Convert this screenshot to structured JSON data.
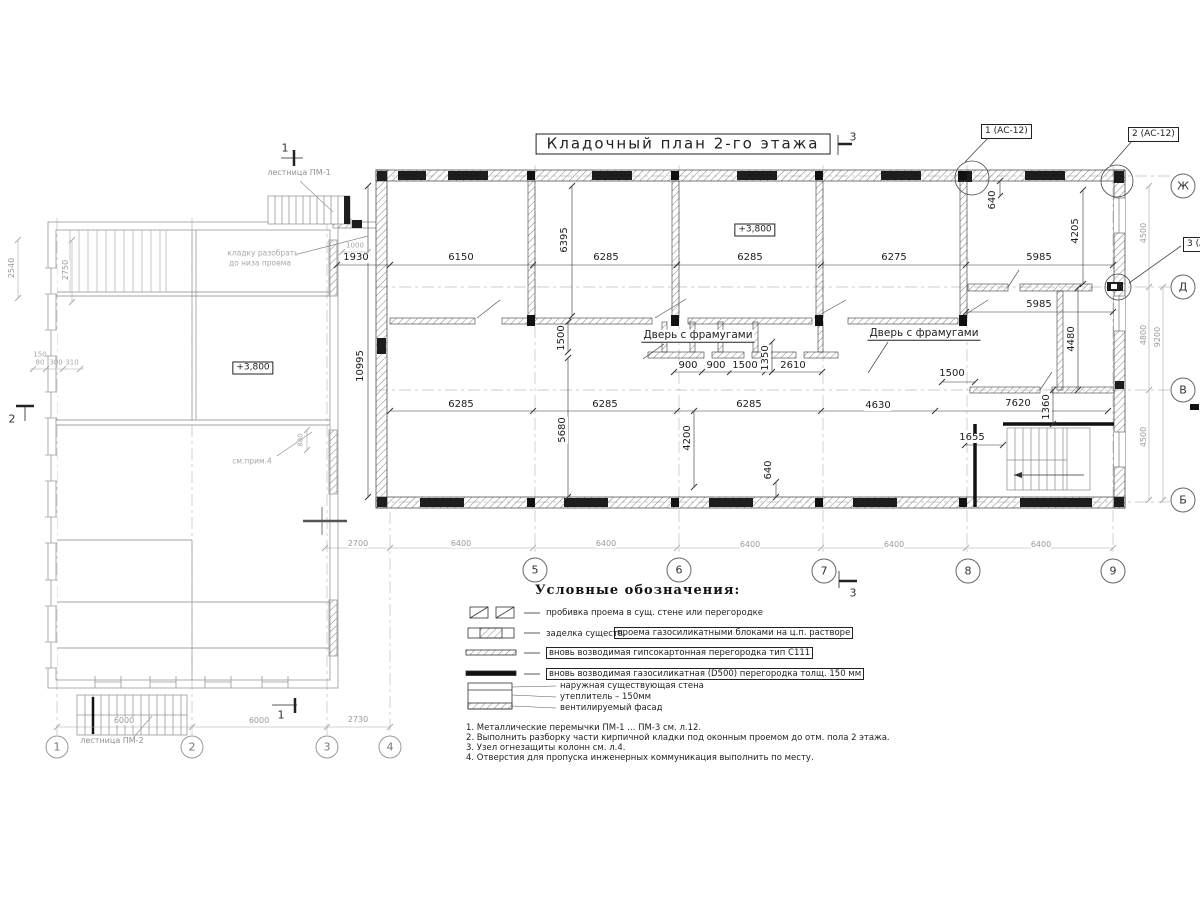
{
  "drawing": {
    "title": "Кладочный план 2-го этажа",
    "level_main": "+3,800",
    "level_left": "+3,800",
    "door_label_left": "Дверь с фрамугами",
    "door_label_right": "Дверь с фрамугами",
    "stair_top": "лестница ПМ-1",
    "stair_bottom": "лестница ПМ-2",
    "demolish_1": "кладку разобрать",
    "demolish_2": "до низа проема",
    "see_note": "см.прим.4",
    "callout_1": "1 (АС-12)",
    "callout_2": "2 (АС-12)",
    "callout_3": "3 (АС-12)"
  },
  "axes": {
    "right": [
      "Ж",
      "Д",
      "В",
      "Б"
    ],
    "bottom_main": [
      "5",
      "6",
      "7",
      "8",
      "9"
    ],
    "bottom_left": [
      "1",
      "2",
      "3",
      "4"
    ]
  },
  "sections": {
    "top_left": "1",
    "left": "2",
    "top": "3",
    "bottom": "3",
    "bottom_left": "1"
  },
  "dims": {
    "top": [
      "1930",
      "6150",
      "6285",
      "6285",
      "6275",
      "5985"
    ],
    "room_right": "5985",
    "mid": [
      "900",
      "900",
      "1500",
      "2610"
    ],
    "mid_right": "1500",
    "low": [
      "6285",
      "6285",
      "6285",
      "4630",
      "7620"
    ],
    "stair": "1655",
    "v": {
      "a": "6395",
      "b": "4205",
      "c": "640",
      "d": "10995",
      "e": "1500",
      "f": "5680",
      "g": "4200",
      "h": "640",
      "i": "1350",
      "j": "1360",
      "k": "4480"
    },
    "bottom": [
      "2700",
      "6400",
      "6400",
      "6400",
      "6400",
      "6400"
    ],
    "left_bottom": [
      "6000",
      "6000",
      "2730"
    ],
    "right_col": [
      "4500",
      "4800",
      "9200",
      "4500"
    ],
    "left_col": [
      "2540",
      "2750"
    ],
    "tiny": [
      "1000",
      "880",
      "150",
      "80",
      "300",
      "310"
    ]
  },
  "legend": {
    "heading": "Условные обозначения:",
    "item1": "пробивка проема  в сущ. стене  или перегородке",
    "item2_plain": "заделка существ.",
    "item2_boxed": "проема газосиликатными блоками на ц.п. растворе",
    "item3": "вновь возводимая гипсокартонная перегородка тип С111",
    "item4": "вновь возводимая газосиликатная (D500) перегородка толщ. 150 мм",
    "wall1": "наружная существующая стена",
    "wall2": "утеплитель – 150мм",
    "wall3": "вентилируемый фасад"
  },
  "notes": [
    "1. Металлические перемычки  ПМ-1 ... ПМ-3 см. л.12.",
    "2. Выполнить разборку части кирпичной кладки под оконным проемом до отм. пола 2 этажа.",
    "3. Узел огнезащиты колонн см. л.4.",
    "4. Отверстия для пропуска инженерных коммуникация выполнить по месту."
  ]
}
